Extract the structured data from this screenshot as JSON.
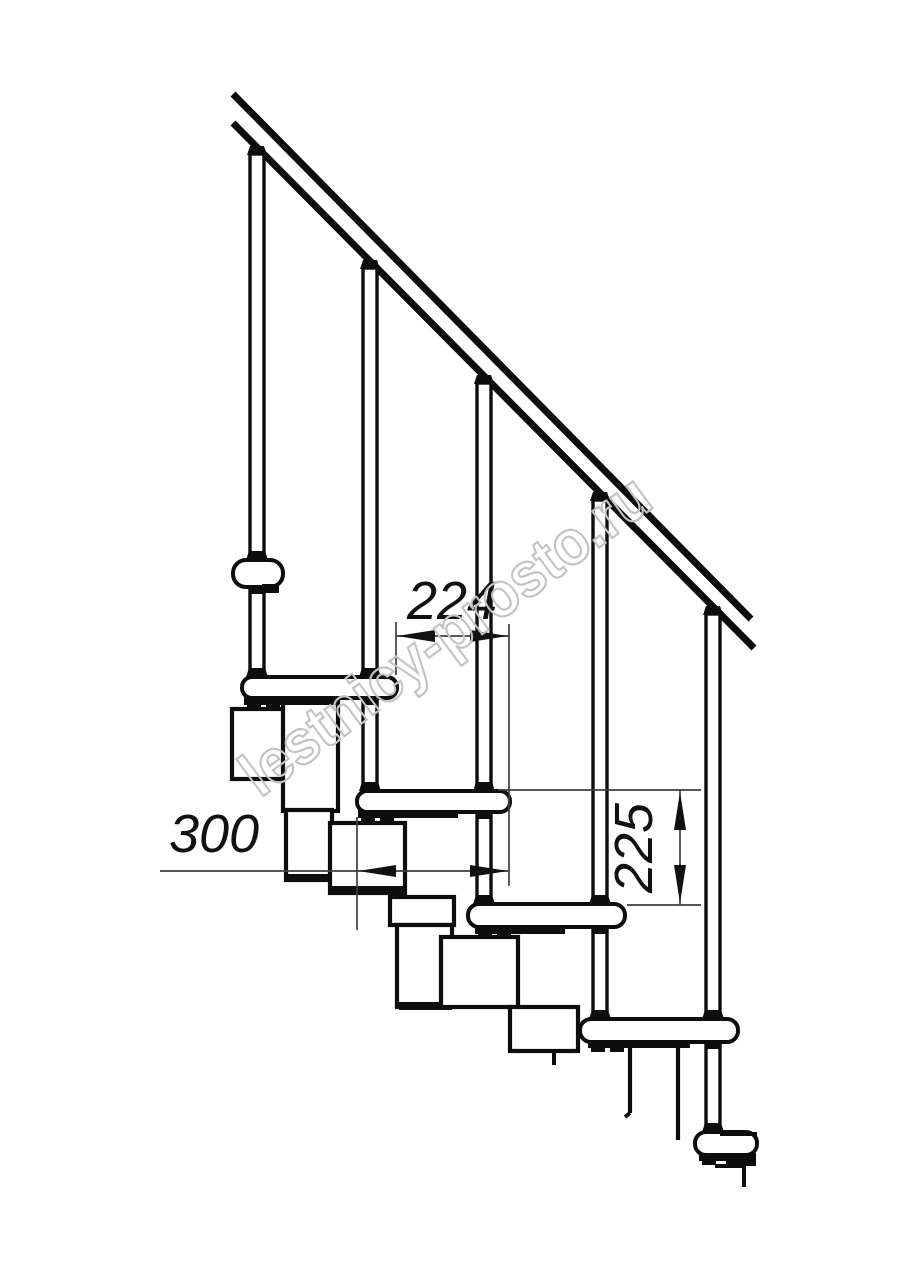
{
  "drawing": {
    "kind": "staircase-side-view-technical-drawing",
    "background": "#ffffff",
    "ink_color": "#0d0d0d",
    "dimension_color": "#3f3f3f"
  },
  "dimensions": {
    "tread_spacing": "224",
    "tread_depth": "300",
    "riser_height": "225"
  },
  "watermark": {
    "text": "lestnicy-prosto.ru",
    "color": "#c3c3c3"
  }
}
